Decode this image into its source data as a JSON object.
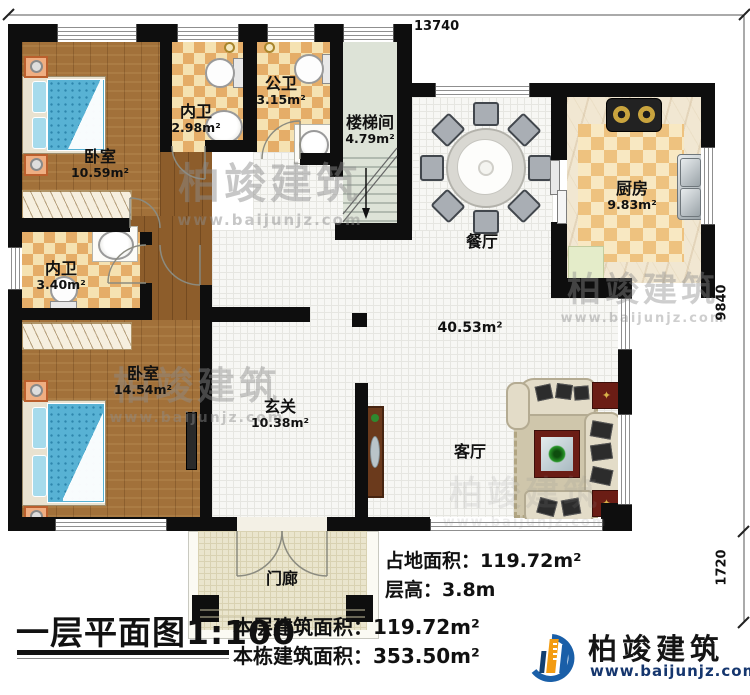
{
  "rooms": {
    "bedroom1": {
      "name": "卧室",
      "area": "10.59m²"
    },
    "ensuite1": {
      "name": "内卫",
      "area": "2.98m²"
    },
    "public_bath": {
      "name": "公卫",
      "area": "3.15m²"
    },
    "stairwell": {
      "name": "楼梯间",
      "area": "4.79m²"
    },
    "kitchen": {
      "name": "厨房",
      "area": "9.83m²"
    },
    "dining": {
      "name": "餐厅"
    },
    "common_area": {
      "area": "40.53m²"
    },
    "foyer": {
      "name": "玄关",
      "area": "10.38m²"
    },
    "living": {
      "name": "客厅"
    },
    "ensuite2": {
      "name": "内卫",
      "area": "3.40m²"
    },
    "bedroom2": {
      "name": "卧室",
      "area": "14.54m²"
    },
    "porch": {
      "name": "门廊"
    }
  },
  "dimensions": {
    "top": "13740",
    "right_upper": "9840",
    "right_lower": "1720"
  },
  "footer": {
    "plan_title": "一层平面图1:100",
    "floor_area": "本层建筑面积：119.72m²",
    "building_area": "本栋建筑面积：353.50m²",
    "site_area": "占地面积：119.72m²",
    "storey_height": "层高：3.8m"
  },
  "branding": {
    "company": "柏竣建筑",
    "website": "www.baijunjz.com"
  }
}
